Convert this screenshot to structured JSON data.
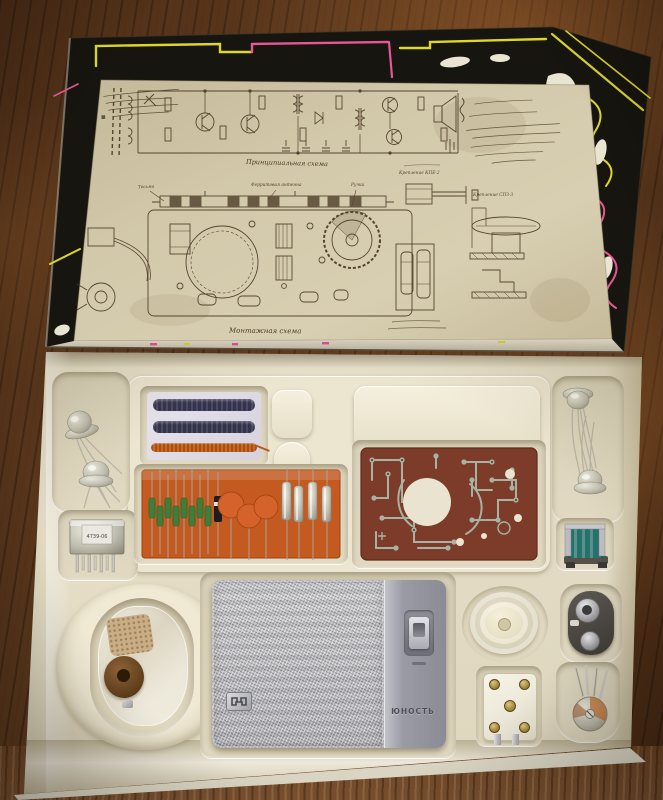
{
  "lid": {
    "captions": {
      "schematic": "Принципиальная схема",
      "assembly": "Монтажная схема"
    },
    "part_labels": {
      "braid": "Тесьма",
      "antenna": "Ферритовая антенна",
      "knob": "Ручка"
    },
    "detail_captions": {
      "kpe": "Крепление КПЕ-2",
      "spz": "Крепление СПЗ-3"
    }
  },
  "tray": {
    "radio": {
      "brand": "ЮНОСТЬ"
    },
    "transformer_marking": "4739-06"
  },
  "colors": {
    "wood": "#54341d",
    "lid_black": "#17150f",
    "accent_yellow": "#ddd62b",
    "accent_pink": "#e85795",
    "paper": "#cdc3a4",
    "ink": "#4a3a26",
    "tray_cream": "#e9e2cc",
    "card_orange": "#c45a20",
    "pcb_brown": "#7d3c2a",
    "radio_silver": "#c2c2c6"
  }
}
